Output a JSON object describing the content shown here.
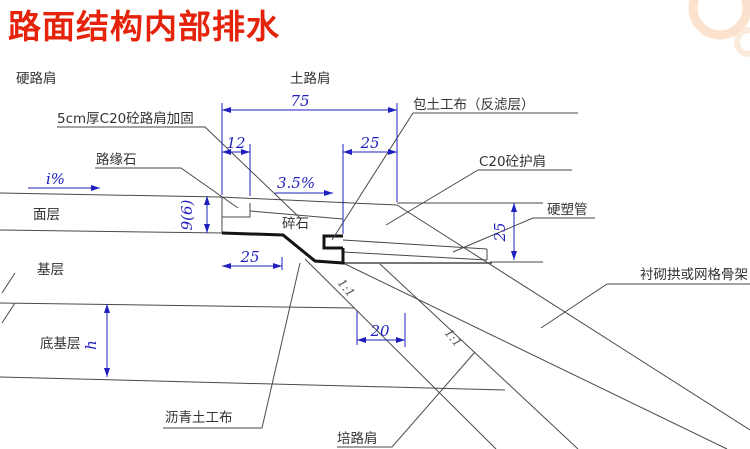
{
  "title": "路面结构内部排水",
  "colors": {
    "title_red": "#e5220a",
    "dimension_blue": "#1f1fbf",
    "line_gray": "#4a4a4a",
    "geotextile_black": "#141414",
    "watermark_peach": "#f8d8bd"
  },
  "diagram": {
    "labels": {
      "hard_shoulder": "硬路肩",
      "soil_shoulder": "土路肩",
      "shoulder_reinforcement": "5cm厚C20砼路肩加固",
      "curb": "路缘石",
      "geotextile_wrap": "包土工布（反滤层）",
      "c20_protect_shoulder": "C20砼护肩",
      "rigid_plastic_pipe": "硬塑管",
      "lining_arch": "衬砌拱或网格骨架",
      "surface_course": "面层",
      "gravel": "碎石",
      "base_course": "基层",
      "subbase_course": "底基层",
      "asphalt_geotextile": "沥青土工布",
      "embankment_shoulder": "培路肩"
    },
    "dimensions": {
      "d75": "75",
      "d12": "12",
      "d25_top": "25",
      "d25_left": "25",
      "d25_right": "25",
      "d20": "20",
      "d9_6": "9(6)",
      "height_h": "h",
      "slope_i": "i%",
      "slope_35": "3.5%",
      "ratio_a": "1:1",
      "ratio_b": "1:1"
    }
  }
}
